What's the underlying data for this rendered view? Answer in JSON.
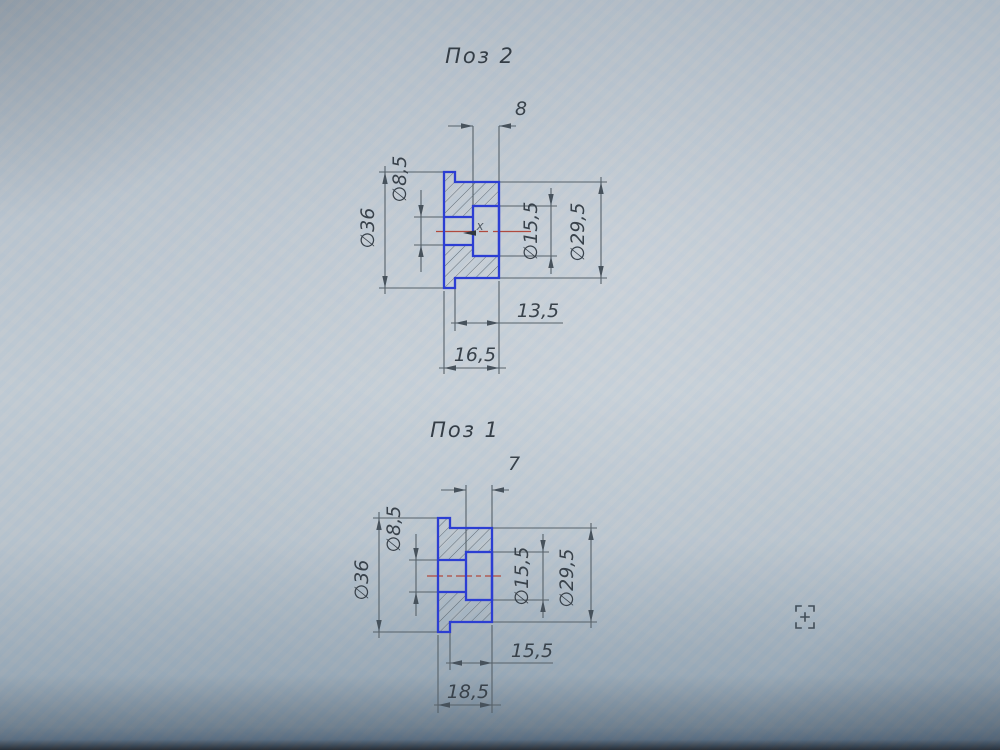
{
  "app": {
    "view": "cad-canvas-photo",
    "colors": {
      "background": "#bcc6ce",
      "selected_outline": "#2c3ed2",
      "centerline": "#b04a3e",
      "dimension_lines": "#566169",
      "text": "#39424b"
    }
  },
  "cursor": {
    "snap_marker": "х",
    "tool_icon": "zoom-crosshair"
  },
  "drawings": [
    {
      "title": "Поз 2",
      "dims": {
        "depth": "8",
        "flange_dia": "∅36",
        "small_bore_dia": "∅8,5",
        "bore_dia": "∅15,5",
        "body_dia": "∅29,5",
        "step_len": "13,5",
        "total_len": "16,5"
      }
    },
    {
      "title": "Поз 1",
      "dims": {
        "depth": "7",
        "flange_dia": "∅36",
        "small_bore_dia": "∅8,5",
        "bore_dia": "∅15,5",
        "body_dia": "∅29,5",
        "step_len": "15,5",
        "total_len": "18,5"
      }
    }
  ]
}
